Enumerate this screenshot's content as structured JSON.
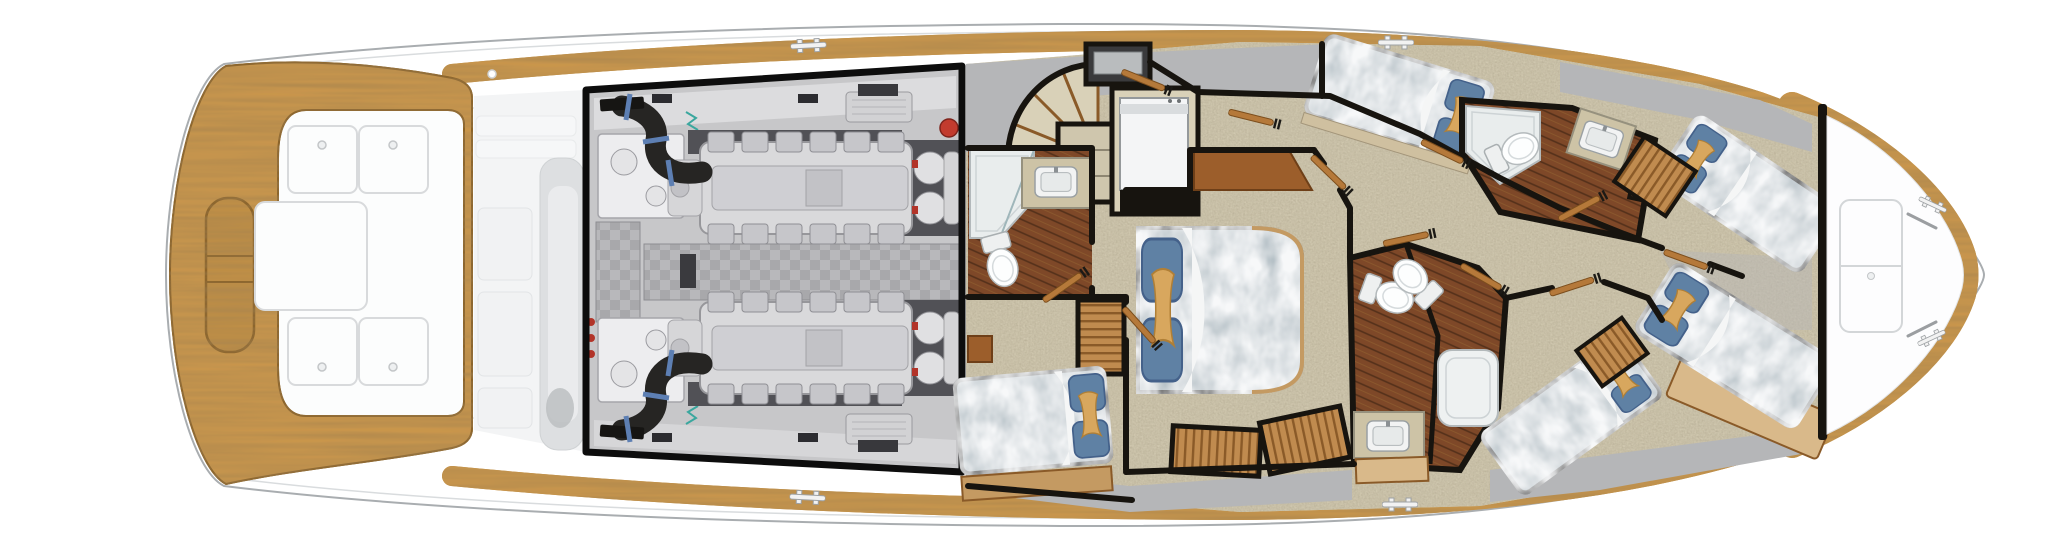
{
  "plan": {
    "kind": "yacht-accommodation-deck-floorplan",
    "view": "overhead",
    "regions": [
      {
        "id": "cockpit",
        "label": "teak cockpit with deck hatches"
      },
      {
        "id": "mezzanine",
        "label": "ghosted mezzanine seating"
      },
      {
        "id": "engine-room",
        "label": "highlighted engine room, twin engines"
      },
      {
        "id": "companionway",
        "label": "curved companionway stairs"
      },
      {
        "id": "laundry",
        "label": "stacked washer-dryer"
      },
      {
        "id": "day-head",
        "label": "aft day head with shower"
      },
      {
        "id": "master-stateroom",
        "label": "master stateroom, walkaround queen berth"
      },
      {
        "id": "port-aft-stateroom",
        "label": "port aft guest stateroom"
      },
      {
        "id": "starboard-stateroom",
        "label": "starboard guest stateroom"
      },
      {
        "id": "mid-heads",
        "label": "mid guest heads with showers"
      },
      {
        "id": "forward-stateroom",
        "label": "forward stateroom, crossed over-under berths"
      },
      {
        "id": "bow-deck",
        "label": "foredeck with hatch, chocks and cleats"
      }
    ],
    "counts": {
      "engines": 2,
      "exhaust_hoses": 2,
      "cockpit_hatches": 5,
      "bow_hatch_panels": 2,
      "rail_cleats": 4,
      "bow_cleats": 2,
      "bow_chocks": 2,
      "berths": 6,
      "toilets": 4,
      "showers": 3,
      "sinks": 3,
      "cedar_closets": 5,
      "doors": 11,
      "stair_treads": 6
    }
  },
  "components": {
    "cleat-icon": "double-bollard deck cleat",
    "chock-icon": "angled line chock",
    "door-icon": "hinged teak cabin door",
    "toilet-icon": "toilet bowl with tank",
    "sink-icon": "rectangular basin with faucet",
    "pillow-set-icon": "two blue pillows with tan accent pillow",
    "hatch-icon": "flush deck hatch with screw latch"
  },
  "palette": {
    "hull_white": "#ffffff",
    "hull_outline": "#a9adb0",
    "inner_line": "#d9dcde",
    "sole_white": "#fcfdfd",
    "sole_edge": "#e8eaeb",
    "teak": "#c9964c",
    "teak_dark": "#8a6227",
    "teak_door": "#b5793a",
    "ghost_light": "#f3f4f5",
    "ghost_mid": "#dddfe1",
    "ghost_dark": "#bcbfc1",
    "frame_black": "#0d0d0d",
    "er_bg": "#c7c7c9",
    "er_band": "#dcdcde",
    "er_dark": "#515156",
    "er_block": "#d9d9db",
    "er_block_edge": "#97979b",
    "er_cover": "#c6c6ca",
    "er_box": "#ededef",
    "hose": "#262523",
    "flange": "#161513",
    "clamp_blue": "#5d7fb3",
    "red": "#b23429",
    "extinguisher": "#c23b2e",
    "teal_wire": "#3aa79e",
    "carpet": "#d9d1b8",
    "gray_deck": "#b5b6b8",
    "wall": "#17140f",
    "plank": "#7e4828",
    "granite": "#cdc3a6",
    "granite_edge": "#96917e",
    "fixture": "#f2f3f3",
    "fixture_edge": "#9aa0a3",
    "shower": "#e9eded",
    "shower_edge": "#b3b9bb",
    "bed_base": "#b6c1c7",
    "bed_edge": "#23201a",
    "sheet": "#f5f6f6",
    "pillow_blue": "#5f81a4",
    "pillow_blue_edge": "#44618a",
    "pillow_tan": "#d8a75e",
    "pillow_tan_edge": "#b07f36",
    "closet_wood": "#c08b4f",
    "closet_seam": "#8a5a28",
    "wood_furniture": "#9c5e2b",
    "wood_edge": "#6e3f18",
    "wood_rail": "#c49a62",
    "board_tan": "#d9b98a"
  }
}
